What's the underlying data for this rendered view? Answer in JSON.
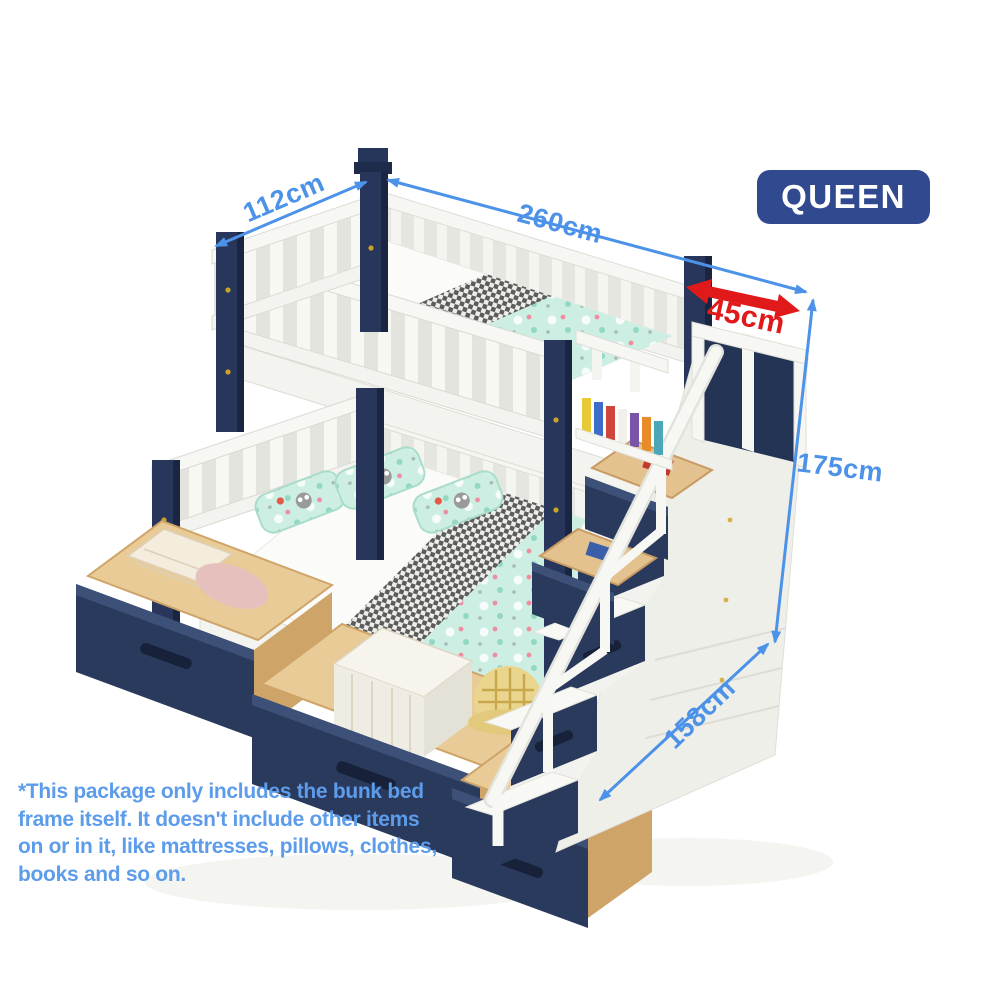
{
  "badge": {
    "label": "QUEEN",
    "bg_color": "#30498F",
    "text_color": "#FFFFFF"
  },
  "dimension_labels": {
    "top_width": "112cm",
    "total_length": "260cm",
    "stair_depth": "45cm",
    "height": "175cm",
    "lower_bed_width": "158cm"
  },
  "annotation_colors": {
    "dimension_blue": "#4C92E8",
    "arrow_red": "#E01A1A"
  },
  "product_palette": {
    "frame_white": "#F7F7F4",
    "frame_navy": "#27365A",
    "drawer_wood": "#D9AF79",
    "bedding_mint": "#CDEFE3",
    "blanket_gray": "#5C5C5C"
  },
  "disclaimer": {
    "color": "#5D9CEA",
    "lines": [
      "*This package only includes the bunk bed",
      "frame itself. It doesn't include other items",
      "on or in it, like mattresses, pillows, clothes,",
      "books and so on."
    ]
  }
}
